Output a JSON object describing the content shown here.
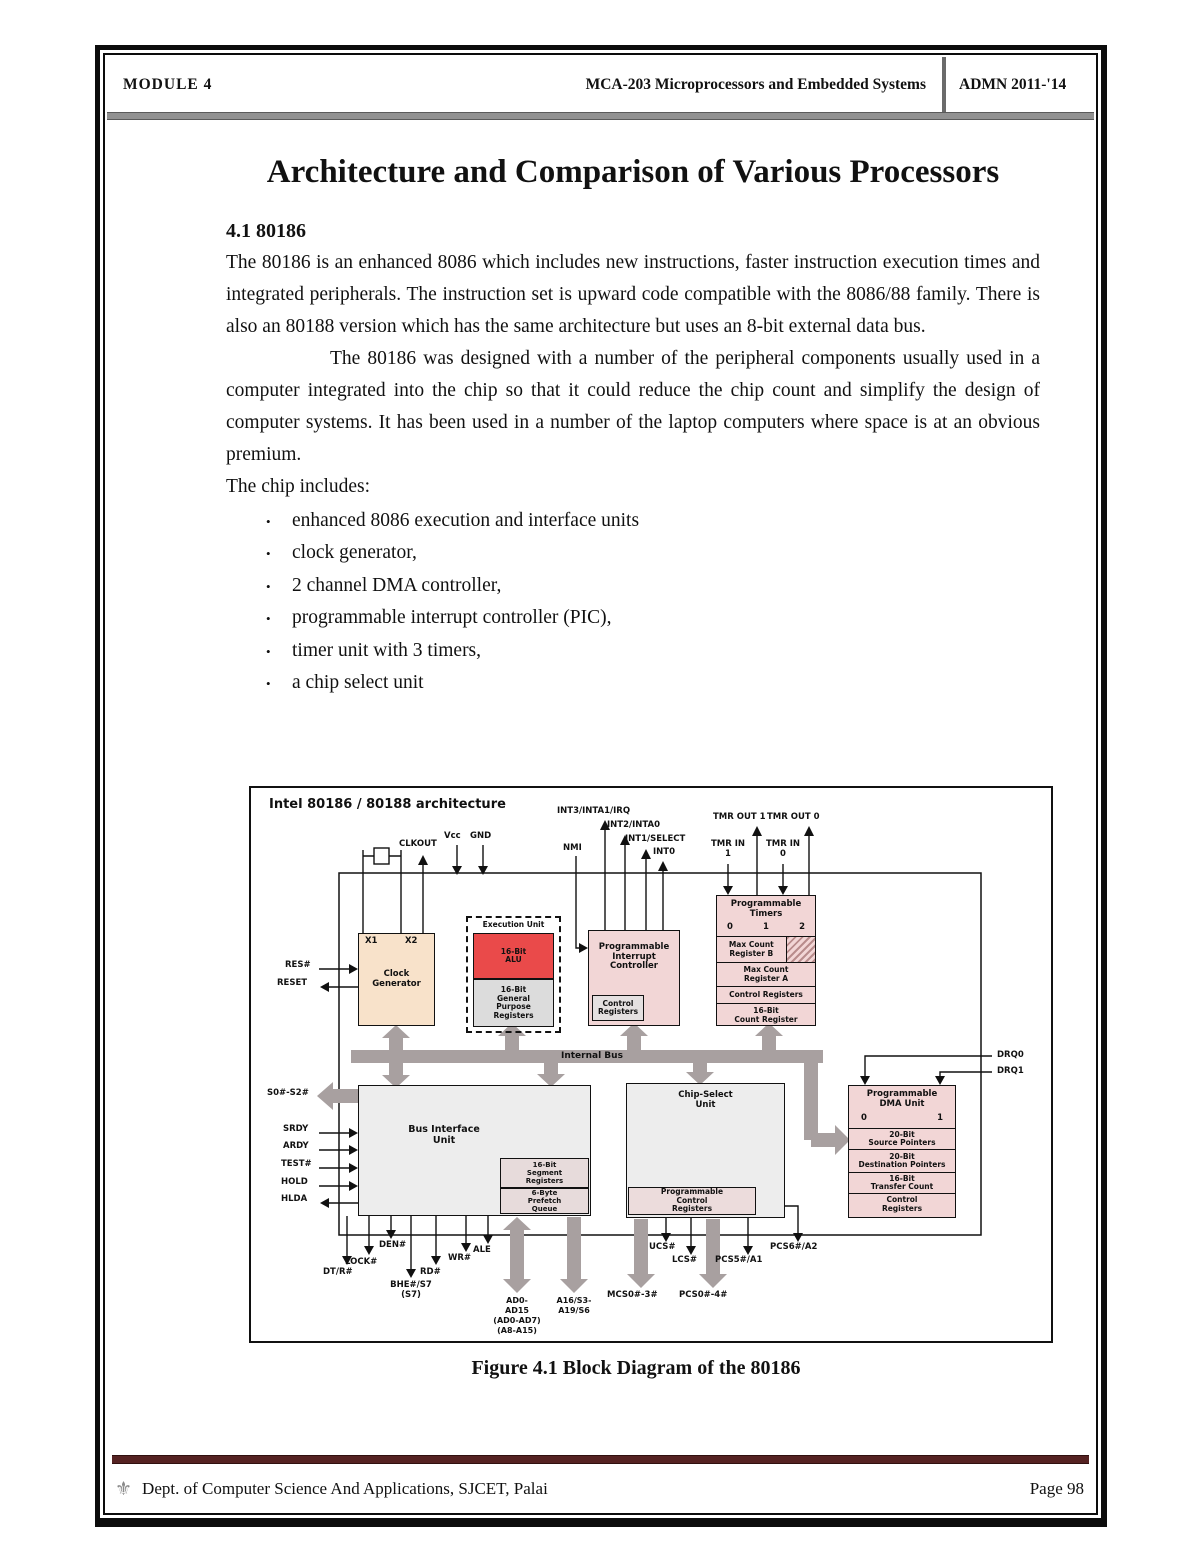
{
  "header": {
    "module": "MODULE 4",
    "course": "MCA-203 Microprocessors and Embedded Systems",
    "admn": "ADMN 2011-'14"
  },
  "doc": {
    "title": "Architecture and Comparison of Various Processors",
    "section_heading": "4.1 80186",
    "para1": "The 80186 is an enhanced 8086 which includes new instructions, faster instruction execution times and integrated peripherals. The instruction set is upward code compatible with the 8086/88 family.  There is also an 80188 version which has the same architecture but uses an 8-bit external data bus.",
    "para2": "The 80186 was designed with a number of the peripheral components usually used in a computer integrated into the chip so that it could reduce the chip count and simplify the design of computer systems.  It has been used in a number of the laptop computers where space is at an obvious premium.",
    "para3": "The chip includes:",
    "bullets": [
      "enhanced 8086 execution and interface units",
      "clock generator,",
      "2 channel DMA controller,",
      "programmable interrupt controller (PIC),",
      "timer unit with 3 timers,",
      "a chip select unit"
    ],
    "figure_caption": "Figure 4.1 Block Diagram of the 80186"
  },
  "diagram": {
    "title": "Intel 80186 / 80188 architecture",
    "bus_label": "Internal Bus",
    "blocks": {
      "clock": "Clock\nGenerator",
      "x1": "X1",
      "x2": "X2",
      "exec": "Execution Unit",
      "alu": "16-Bit\nALU",
      "gpr": "16-Bit\nGeneral\nPurpose\nRegisters",
      "pic": "Programmable\nInterrupt\nController",
      "pic_sub": "Control\nRegisters",
      "timers": "Programmable\nTimers",
      "t0": "0",
      "t1": "1",
      "t2": "2",
      "timer_rows": [
        "Max Count\nRegister B",
        "Max Count\nRegister A",
        "Control Registers",
        "16-Bit\nCount Register"
      ],
      "biu": "Bus Interface\nUnit",
      "seg": "16-Bit\nSegment\nRegisters",
      "queue": "6-Byte\nPrefetch\nQueue",
      "cs": "Chip-Select\nUnit",
      "cs_sub": "Programmable\nControl\nRegisters",
      "dma": "Programmable\nDMA Unit",
      "dma0": "0",
      "dma1": "1",
      "dma_rows": [
        "20-Bit\nSource Pointers",
        "20-Bit\nDestination Pointers",
        "16-Bit\nTransfer Count",
        "Control\nRegisters"
      ]
    },
    "pins": {
      "clkout": "CLKOUT",
      "vcc": "Vcc",
      "gnd": "GND",
      "nmi": "NMI",
      "int3": "INT3/INTA1/IRQ",
      "int2": "INT2/INTA0",
      "int1": "INT1/SELECT",
      "int0": "INT0",
      "tmrout1": "TMR OUT 1",
      "tmrout0": "TMR OUT 0",
      "tmrin1": "TMR IN\n1",
      "tmrin0": "TMR IN\n0",
      "res": "RES#",
      "reset": "RESET",
      "s0s2": "S0#-S2#",
      "srdy": "SRDY",
      "ardy": "ARDY",
      "test": "TEST#",
      "hold": "HOLD",
      "hlda": "HLDA",
      "drq0": "DRQ0",
      "drq1": "DRQ1",
      "dtr": "DT/R#",
      "lock": "LOCK#",
      "den": "DEN#",
      "bhe": "BHE#/S7\n(S7)",
      "rd": "RD#",
      "wr": "WR#",
      "ale": "ALE",
      "ad": "AD0-\nAD15\n(AD0-AD7)\n(A8-A15)",
      "a16": "A16/S3-\nA19/S6",
      "mcs": "MCS0#-3#",
      "pcs04": "PCS0#-4#",
      "ucs": "UCS#",
      "lcs": "LCS#",
      "pcs5": "PCS5#/A1",
      "pcs6": "PCS6#/A2"
    },
    "colors": {
      "alu_red": "#ea4a4a",
      "block_pink": "#f2d6d6",
      "clock_peach": "#f8e2ca",
      "bus_gray": "#a8a0a0"
    }
  },
  "footer": {
    "dept": "Dept. of Computer Science And Applications, SJCET, Palai",
    "page": "Page 98",
    "logo_glyph": "⚜"
  }
}
